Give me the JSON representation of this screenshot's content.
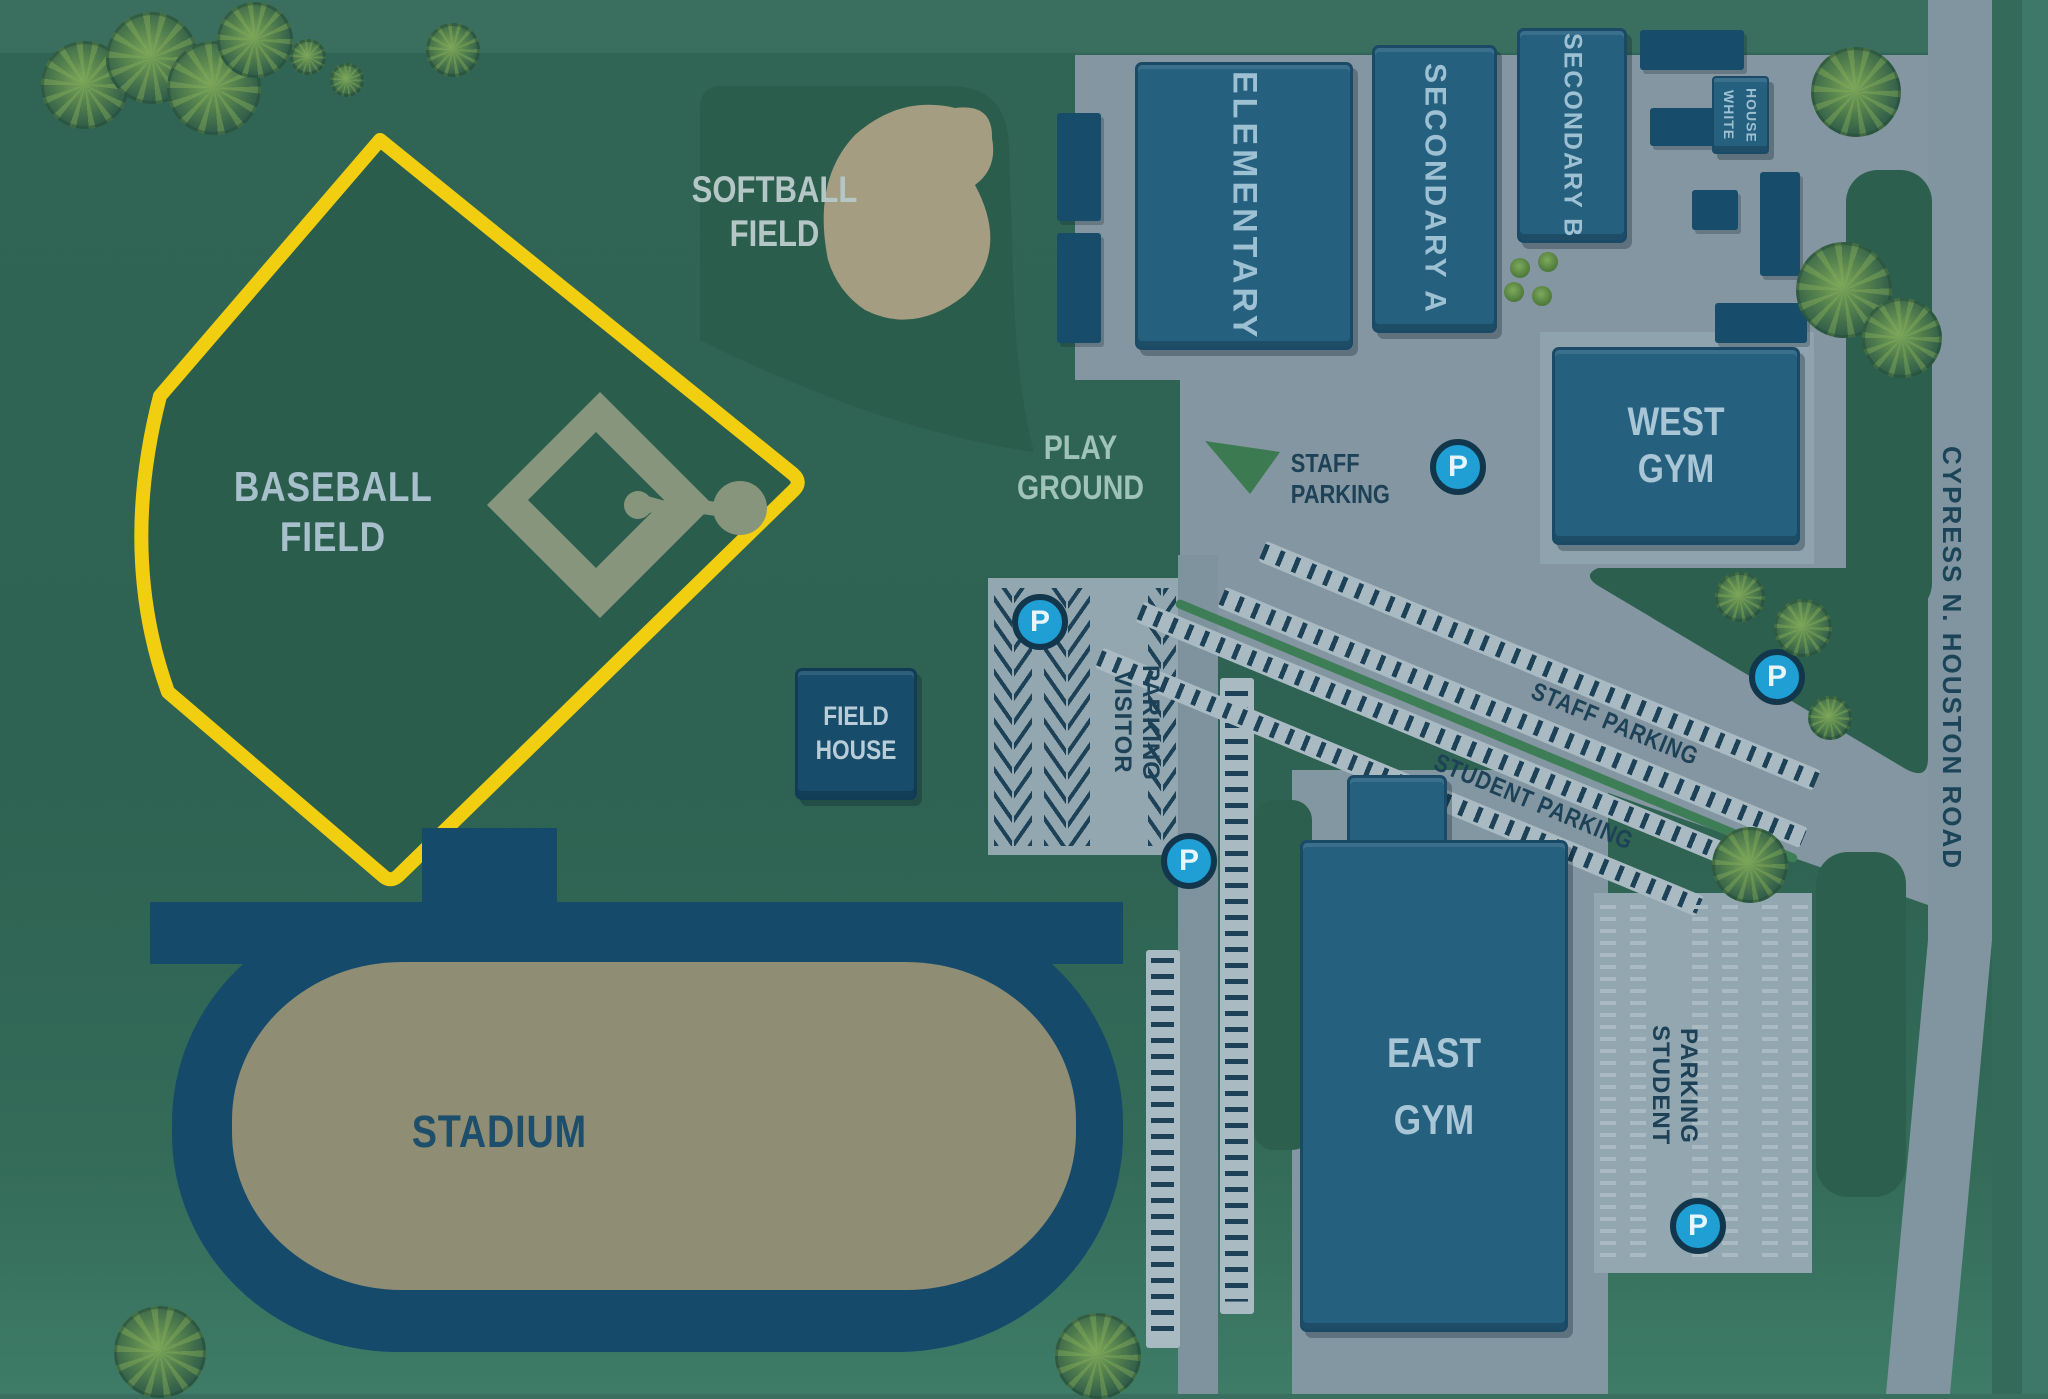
{
  "areas": {
    "baseball": {
      "label": "BASEBALL FIELD"
    },
    "softball": {
      "label": "SOFTBALL FIELD"
    },
    "playground": {
      "label": "PLAY GROUND"
    },
    "field_house": {
      "label": "FIELD HOUSE"
    },
    "stadium": {
      "label": "STADIUM"
    },
    "east_gym": {
      "label": "EAST GYM"
    },
    "west_gym": {
      "label": "WEST GYM"
    }
  },
  "buildings": {
    "elementary": {
      "label": "ELEMENTARY"
    },
    "secondary_a": {
      "label": "SECONDARY A"
    },
    "secondary_b": {
      "label": "SECONDARY B"
    },
    "white_house": {
      "label": "WHITE HOUSE"
    }
  },
  "parking": {
    "p": "P",
    "staff_sign": {
      "label": "STAFF PARKING"
    },
    "staff_diagonal": {
      "label": "STAFF PARKING"
    },
    "student_diagonal": {
      "label": "STUDENT PARKING"
    },
    "visitor": {
      "label": "VISITOR PARKING"
    },
    "student_lot": {
      "label": "STUDENT PARKING"
    }
  },
  "roads": {
    "cypress": {
      "label": "CYPRESS N. HOUSTON ROAD"
    }
  },
  "highlight": {
    "target": "baseball-field",
    "color": "#F2CE10"
  },
  "colors": {
    "background_green": "#2E6252",
    "field_green": "#2B5D4C",
    "pavement_gray": "#8496A1",
    "building_blue": "#26607F",
    "navy": "#174C6A",
    "stadium_tan": "#8F8D73",
    "p_marker_blue": "#1F9FD4",
    "stripe_navy": "#1D4156"
  }
}
